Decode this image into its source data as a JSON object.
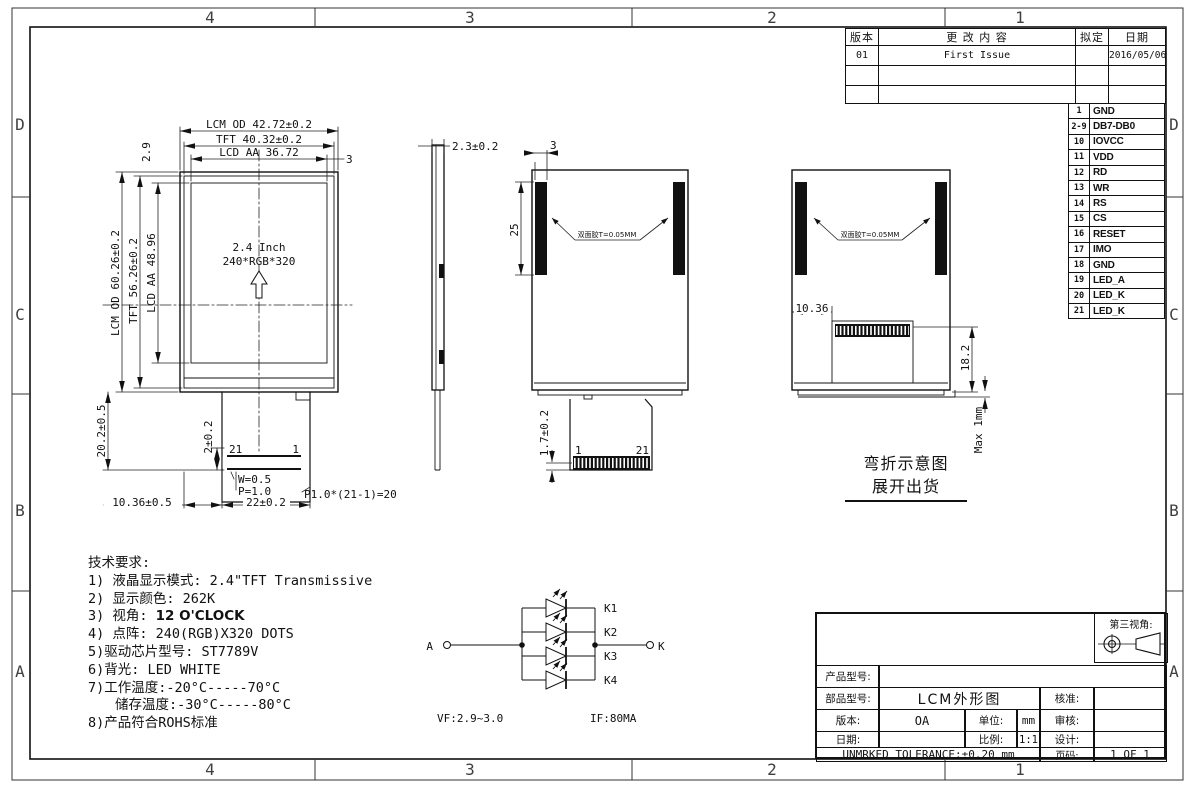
{
  "border": {
    "top_zones": [
      "4",
      "3",
      "2",
      "1"
    ],
    "bottom_zones": [
      "4",
      "3",
      "2",
      "1"
    ],
    "left_zones": [
      "D",
      "C",
      "B",
      "A"
    ],
    "right_zones": [
      "D",
      "C",
      "B",
      "A"
    ]
  },
  "revision_table": {
    "headers": [
      "版本",
      "更 改 内 容",
      "拟定",
      "日期"
    ],
    "rows": [
      [
        "01",
        "First Issue",
        "",
        "2016/05/06"
      ],
      [
        "",
        "",
        "",
        ""
      ],
      [
        "",
        "",
        "",
        ""
      ]
    ]
  },
  "pin_table": {
    "rows": [
      {
        "no": "1",
        "name": "GND"
      },
      {
        "no": "2-9",
        "name": "DB7-DB0"
      },
      {
        "no": "10",
        "name": "IOVCC"
      },
      {
        "no": "11",
        "name": "VDD"
      },
      {
        "no": "12",
        "name": "RD"
      },
      {
        "no": "13",
        "name": "WR"
      },
      {
        "no": "14",
        "name": "RS"
      },
      {
        "no": "15",
        "name": "CS"
      },
      {
        "no": "16",
        "name": "RESET"
      },
      {
        "no": "17",
        "name": "IMO"
      },
      {
        "no": "18",
        "name": "GND"
      },
      {
        "no": "19",
        "name": "LED_A"
      },
      {
        "no": "20",
        "name": "LED_K"
      },
      {
        "no": "21",
        "name": "LED_K"
      }
    ]
  },
  "front_view": {
    "screen_size": "2.4 Inch",
    "resolution": "240*RGB*320",
    "dim_lcm_od_w": "LCM OD 42.72±0.2",
    "dim_tft_w": "TFT 40.32±0.2",
    "dim_lcd_aa_w": "LCD AA 36.72",
    "dim_top_right": "3",
    "dim_top_left": "2.9",
    "dim_lcm_od_h": "LCM OD 60.26±0.2",
    "dim_tft_h": "TFT 56.26±0.2",
    "dim_lcd_aa_h": "LCD AA 48.96",
    "dim_fpc_drop": "20.2±0.5",
    "dim_fpc_2": "2±0.2",
    "dim_pin_w": "W=0.5",
    "dim_pin_p": "P=1.0",
    "dim_pitch": "P1.0*(21-1)=20",
    "dim_offset": "10.36±0.5",
    "dim_fpc_w": "22±0.2",
    "pin_first": "1",
    "pin_last": "21"
  },
  "side_view": {
    "dim_thickness": "2.3±0.2"
  },
  "rear_view": {
    "dim_tape_w": "3",
    "dim_tape_h": "25",
    "tape_label": "双面胶T=0.05MM",
    "dim_fpc_tail": "1.7±0.2",
    "pin_first": "1",
    "pin_last": "21"
  },
  "bend_view": {
    "tape_label": "双面胶T=0.05MM",
    "dim_offset": "10.36",
    "dim_fold": "18.2",
    "dim_max": "Max 1mm",
    "caption_line1": "弯折示意图",
    "caption_line2": "展开出货"
  },
  "tech_notes": {
    "title": "技术要求:",
    "line1": "1) 液晶显示模式: 2.4\"TFT Transmissive",
    "line2": "2) 显示颜色: 262K",
    "line3_prefix": "3) 视角: ",
    "line3_bold": "12 O'CLOCK",
    "line4": "4) 点阵: 240(RGB)X320 DOTS",
    "line5": "5)驱动芯片型号: ST7789V",
    "line6": "6)背光: LED WHITE",
    "line7": "7)工作温度:-20°C-----70°C",
    "line8": "储存温度:-30°C-----80°C",
    "line9": "8)产品符合ROHS标准"
  },
  "led_circuit": {
    "anode_label": "A",
    "cathode_label": "K",
    "branch_labels": [
      "K1",
      "K2",
      "K3",
      "K4"
    ],
    "spec_vf": "VF:2.9~3.0",
    "spec_if": "IF:80MA"
  },
  "title_block": {
    "third_angle_label": "第三视角:",
    "product_model_label": "产品型号:",
    "part_label": "部品型号:",
    "part_value": "LCM外形图",
    "approve_label": "核准:",
    "version_label": "版本:",
    "version_value": "OA",
    "unit_label": "单位:",
    "unit_value": "mm",
    "review_label": "审核:",
    "date_label": "日期:",
    "scale_label": "比例:",
    "scale_value": "1:1",
    "design_label": "设计:",
    "tolerance": "UNMRKED TOLERANCE:±0.20 mm",
    "page_label": "页码:",
    "page_value": "1 OF 1"
  }
}
